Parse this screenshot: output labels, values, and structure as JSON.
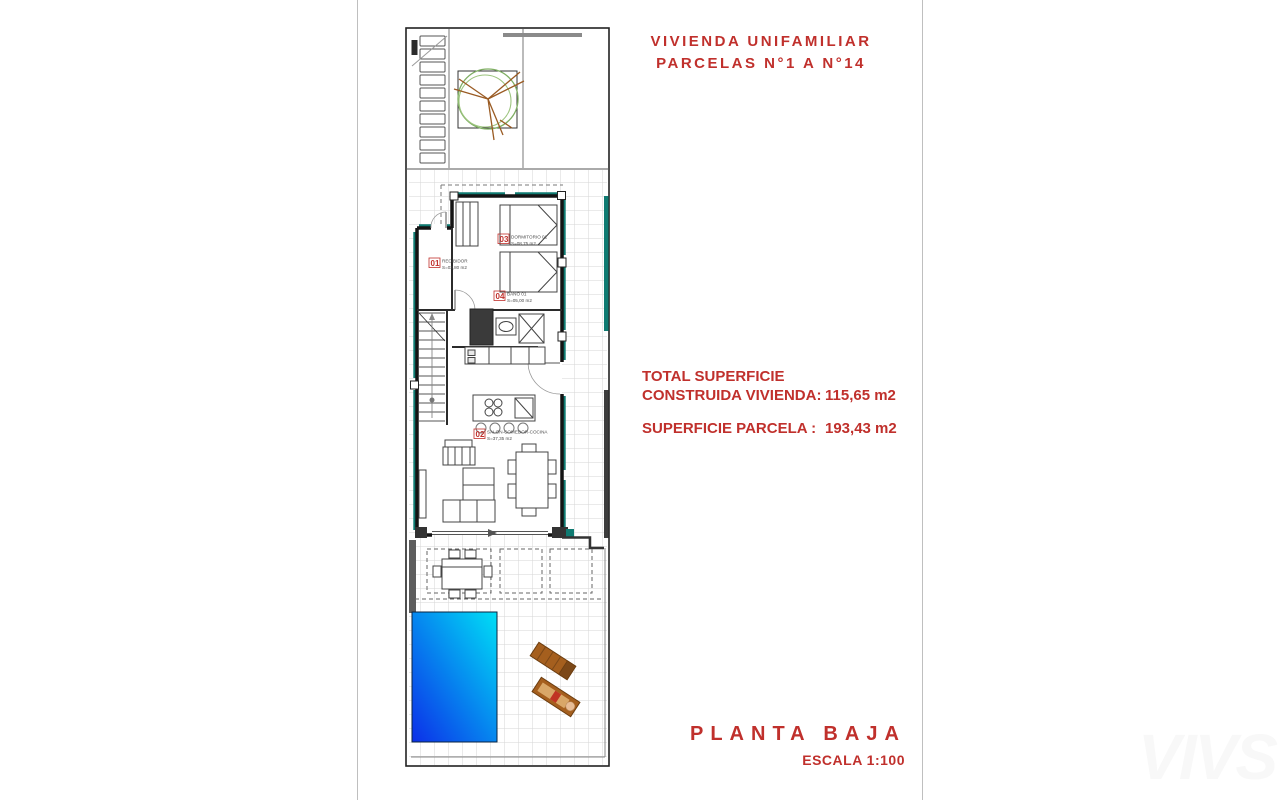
{
  "header": {
    "title_line1": "VIVIENDA UNIFAMILIAR",
    "title_line2": "PARCELAS N°1 A N°14"
  },
  "summary": {
    "total_label_line1": "TOTAL SUPERFICIE",
    "total_label_line2": "CONSTRUIDA VIVIENDA:",
    "total_value": "115,65 m2",
    "parcel_label": "SUPERFICIE PARCELA :",
    "parcel_value": "193,43 m2"
  },
  "footer": {
    "plan_name": "PLANTA BAJA",
    "scale": "ESCALA 1:100"
  },
  "watermark": "VIVS",
  "plan": {
    "rooms": [
      {
        "code": "01",
        "name": "RECIBIDOR",
        "area": "S=03,80 m2"
      },
      {
        "code": "02",
        "name": "SALON-COMEDOR-COCINA",
        "area": "S=37,35 m2"
      },
      {
        "code": "03",
        "name": "DORMITORIO 01",
        "area": "S=08,75 m2"
      },
      {
        "code": "04",
        "name": "BAÑO 01",
        "area": "S=05,00 m2"
      }
    ]
  },
  "colors": {
    "accent_red": "#c0302c",
    "wall_teal": "#0f7b72",
    "pool_blue": "#0c2fe8",
    "pool_cyan": "#00dff6"
  }
}
